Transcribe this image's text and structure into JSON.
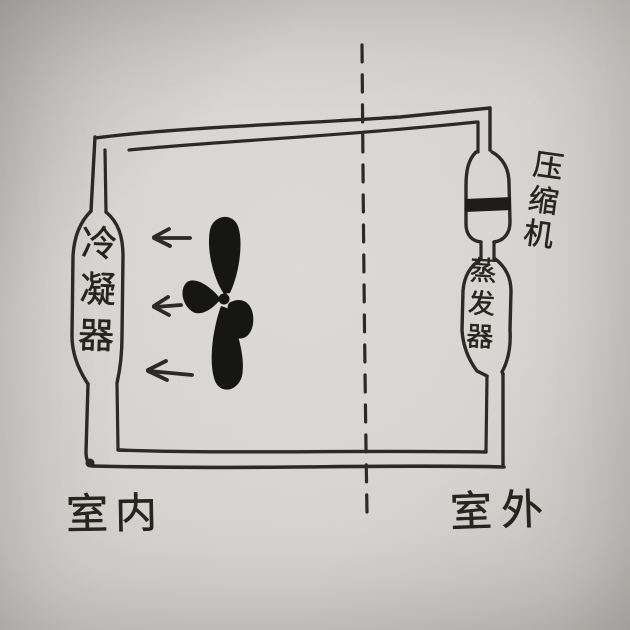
{
  "labels": {
    "condenser": "冷凝器",
    "compressor": "压缩机",
    "evaporator": "蒸发器",
    "indoor": "室内",
    "outdoor": "室外"
  },
  "icons": {
    "fan": "fan-icon",
    "airflow_arrow": "left-arrow-icon",
    "partition": "dashed-partition-line"
  },
  "colors": {
    "paper": "#d7d5d2",
    "ink": "#2b2a28"
  },
  "airflow_arrow_count": 3
}
